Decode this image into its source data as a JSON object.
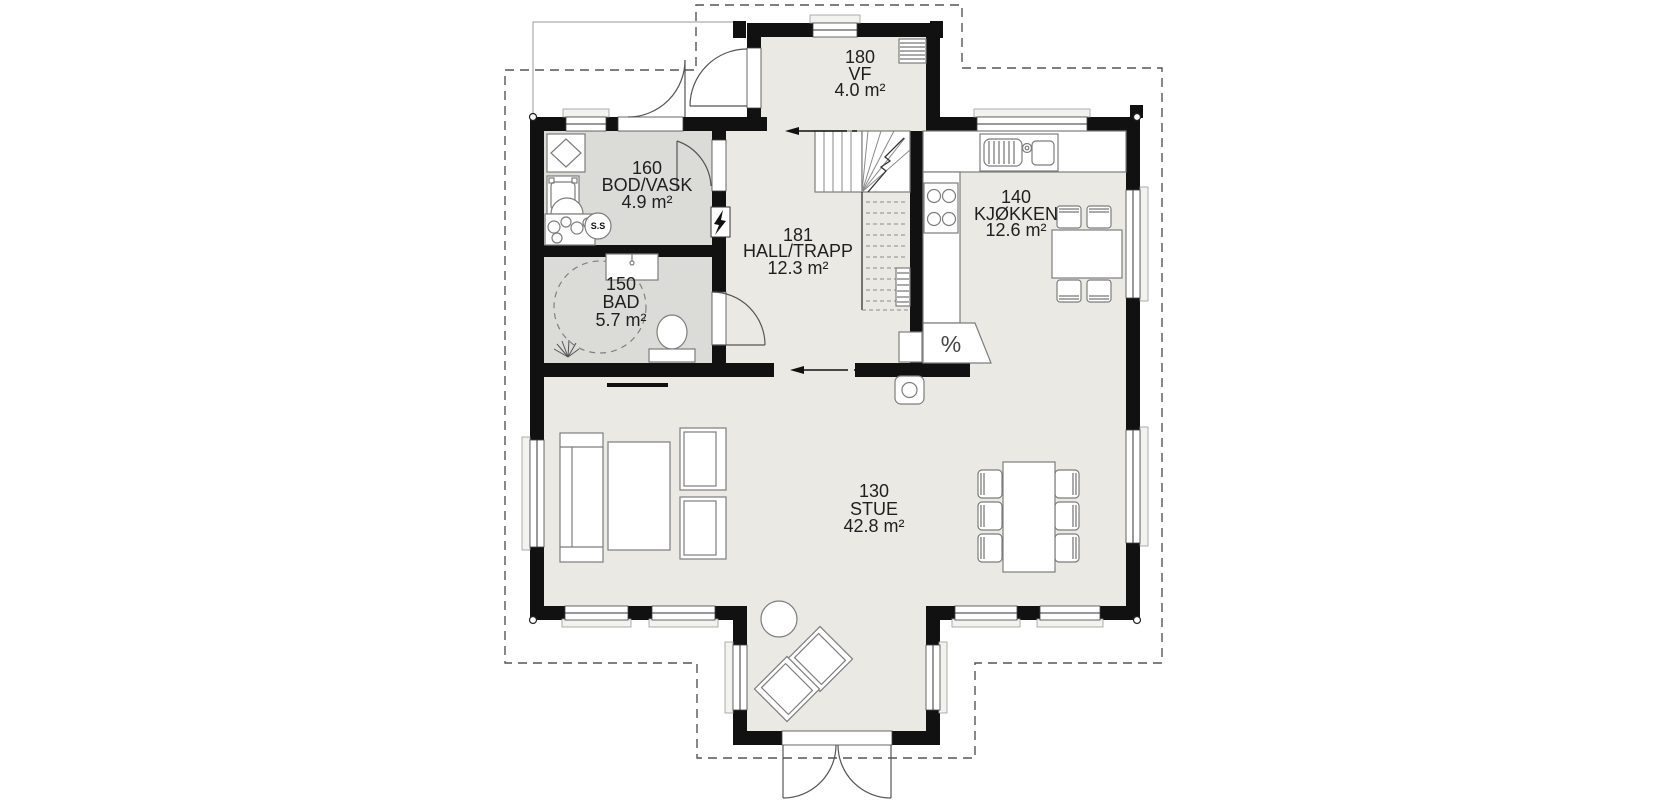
{
  "plan": {
    "type": "first-floor plan",
    "rooms": [
      {
        "id": "vf",
        "number": "180",
        "name": "VF",
        "area": "4.0 m²"
      },
      {
        "id": "bod",
        "number": "160",
        "name": "BOD/VASK",
        "area": "4.9 m²"
      },
      {
        "id": "bad",
        "number": "150",
        "name": "BAD",
        "area": "5.7 m²"
      },
      {
        "id": "hall",
        "number": "181",
        "name": "HALL/TRAPP",
        "area": "12.3 m²"
      },
      {
        "id": "kjokken",
        "number": "140",
        "name": "KJØKKEN",
        "area": "12.6 m²"
      },
      {
        "id": "stue",
        "number": "130",
        "name": "STUE",
        "area": "42.8 m²"
      }
    ],
    "fixture_labels": {
      "laundry_unit": "S.S",
      "kitchen_appliance": "%"
    }
  },
  "colors": {
    "wall": "#111111",
    "floor_main": "#ebe9e3",
    "floor_wet": "#dbdbd7",
    "outline_dash": "#555555"
  }
}
